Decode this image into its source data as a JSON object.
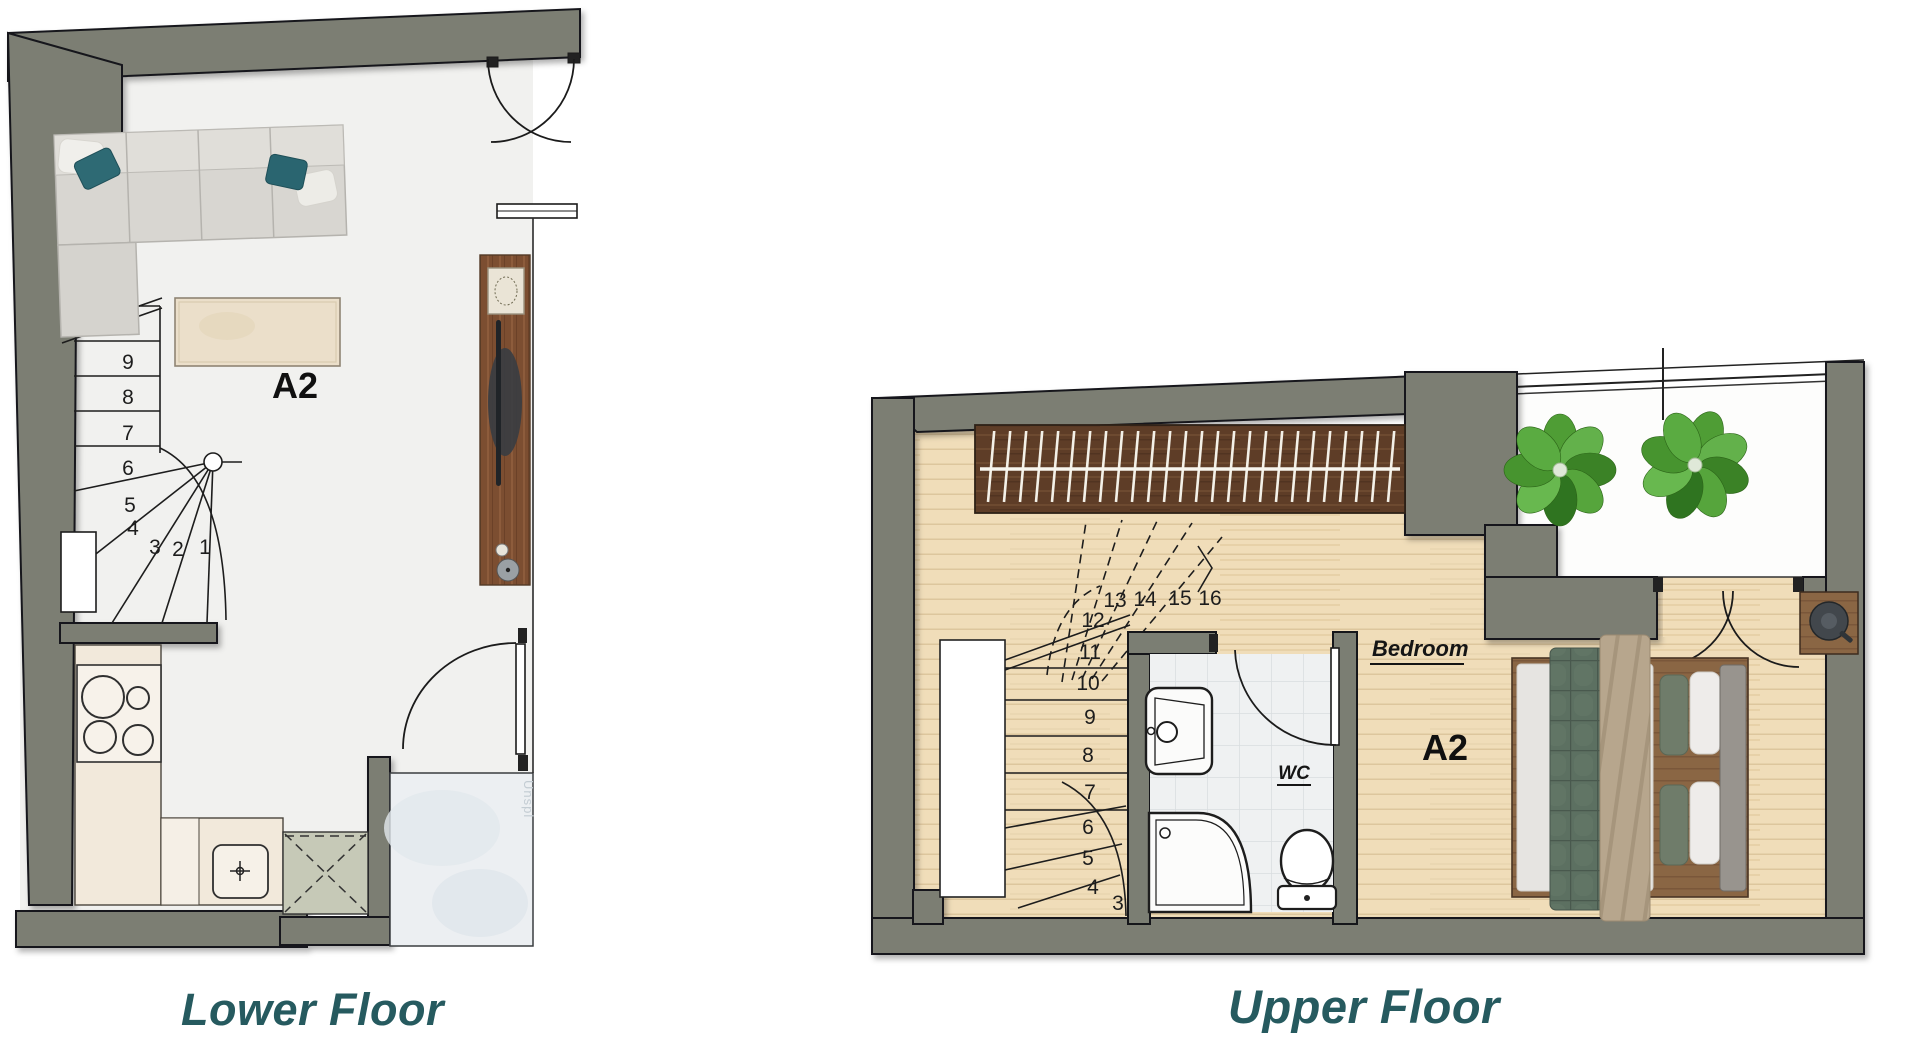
{
  "titles": {
    "lower": "Lower Floor",
    "upper": "Upper Floor"
  },
  "lower_floor": {
    "unit_label": "A2",
    "stairs": {
      "numbers": [
        "1",
        "2",
        "3",
        "4",
        "5",
        "6",
        "7",
        "8",
        "9"
      ]
    },
    "entry_watermark": "Unspl"
  },
  "upper_floor": {
    "unit_label": "A2",
    "bedroom_label": "Bedroom",
    "wc_label": "WC",
    "stairs": {
      "numbers": [
        "3",
        "4",
        "5",
        "6",
        "7",
        "8",
        "9",
        "10",
        "11",
        "12",
        "13",
        "14",
        "15",
        "16"
      ]
    }
  },
  "colors": {
    "wall": "#7b7e73",
    "title_teal": "#265a5f",
    "wood_floor": "#f0ddb9",
    "plant_green": "#4f9d35",
    "pillow_teal": "#2e6a74",
    "sage_appliance": "#c6c9b7"
  }
}
